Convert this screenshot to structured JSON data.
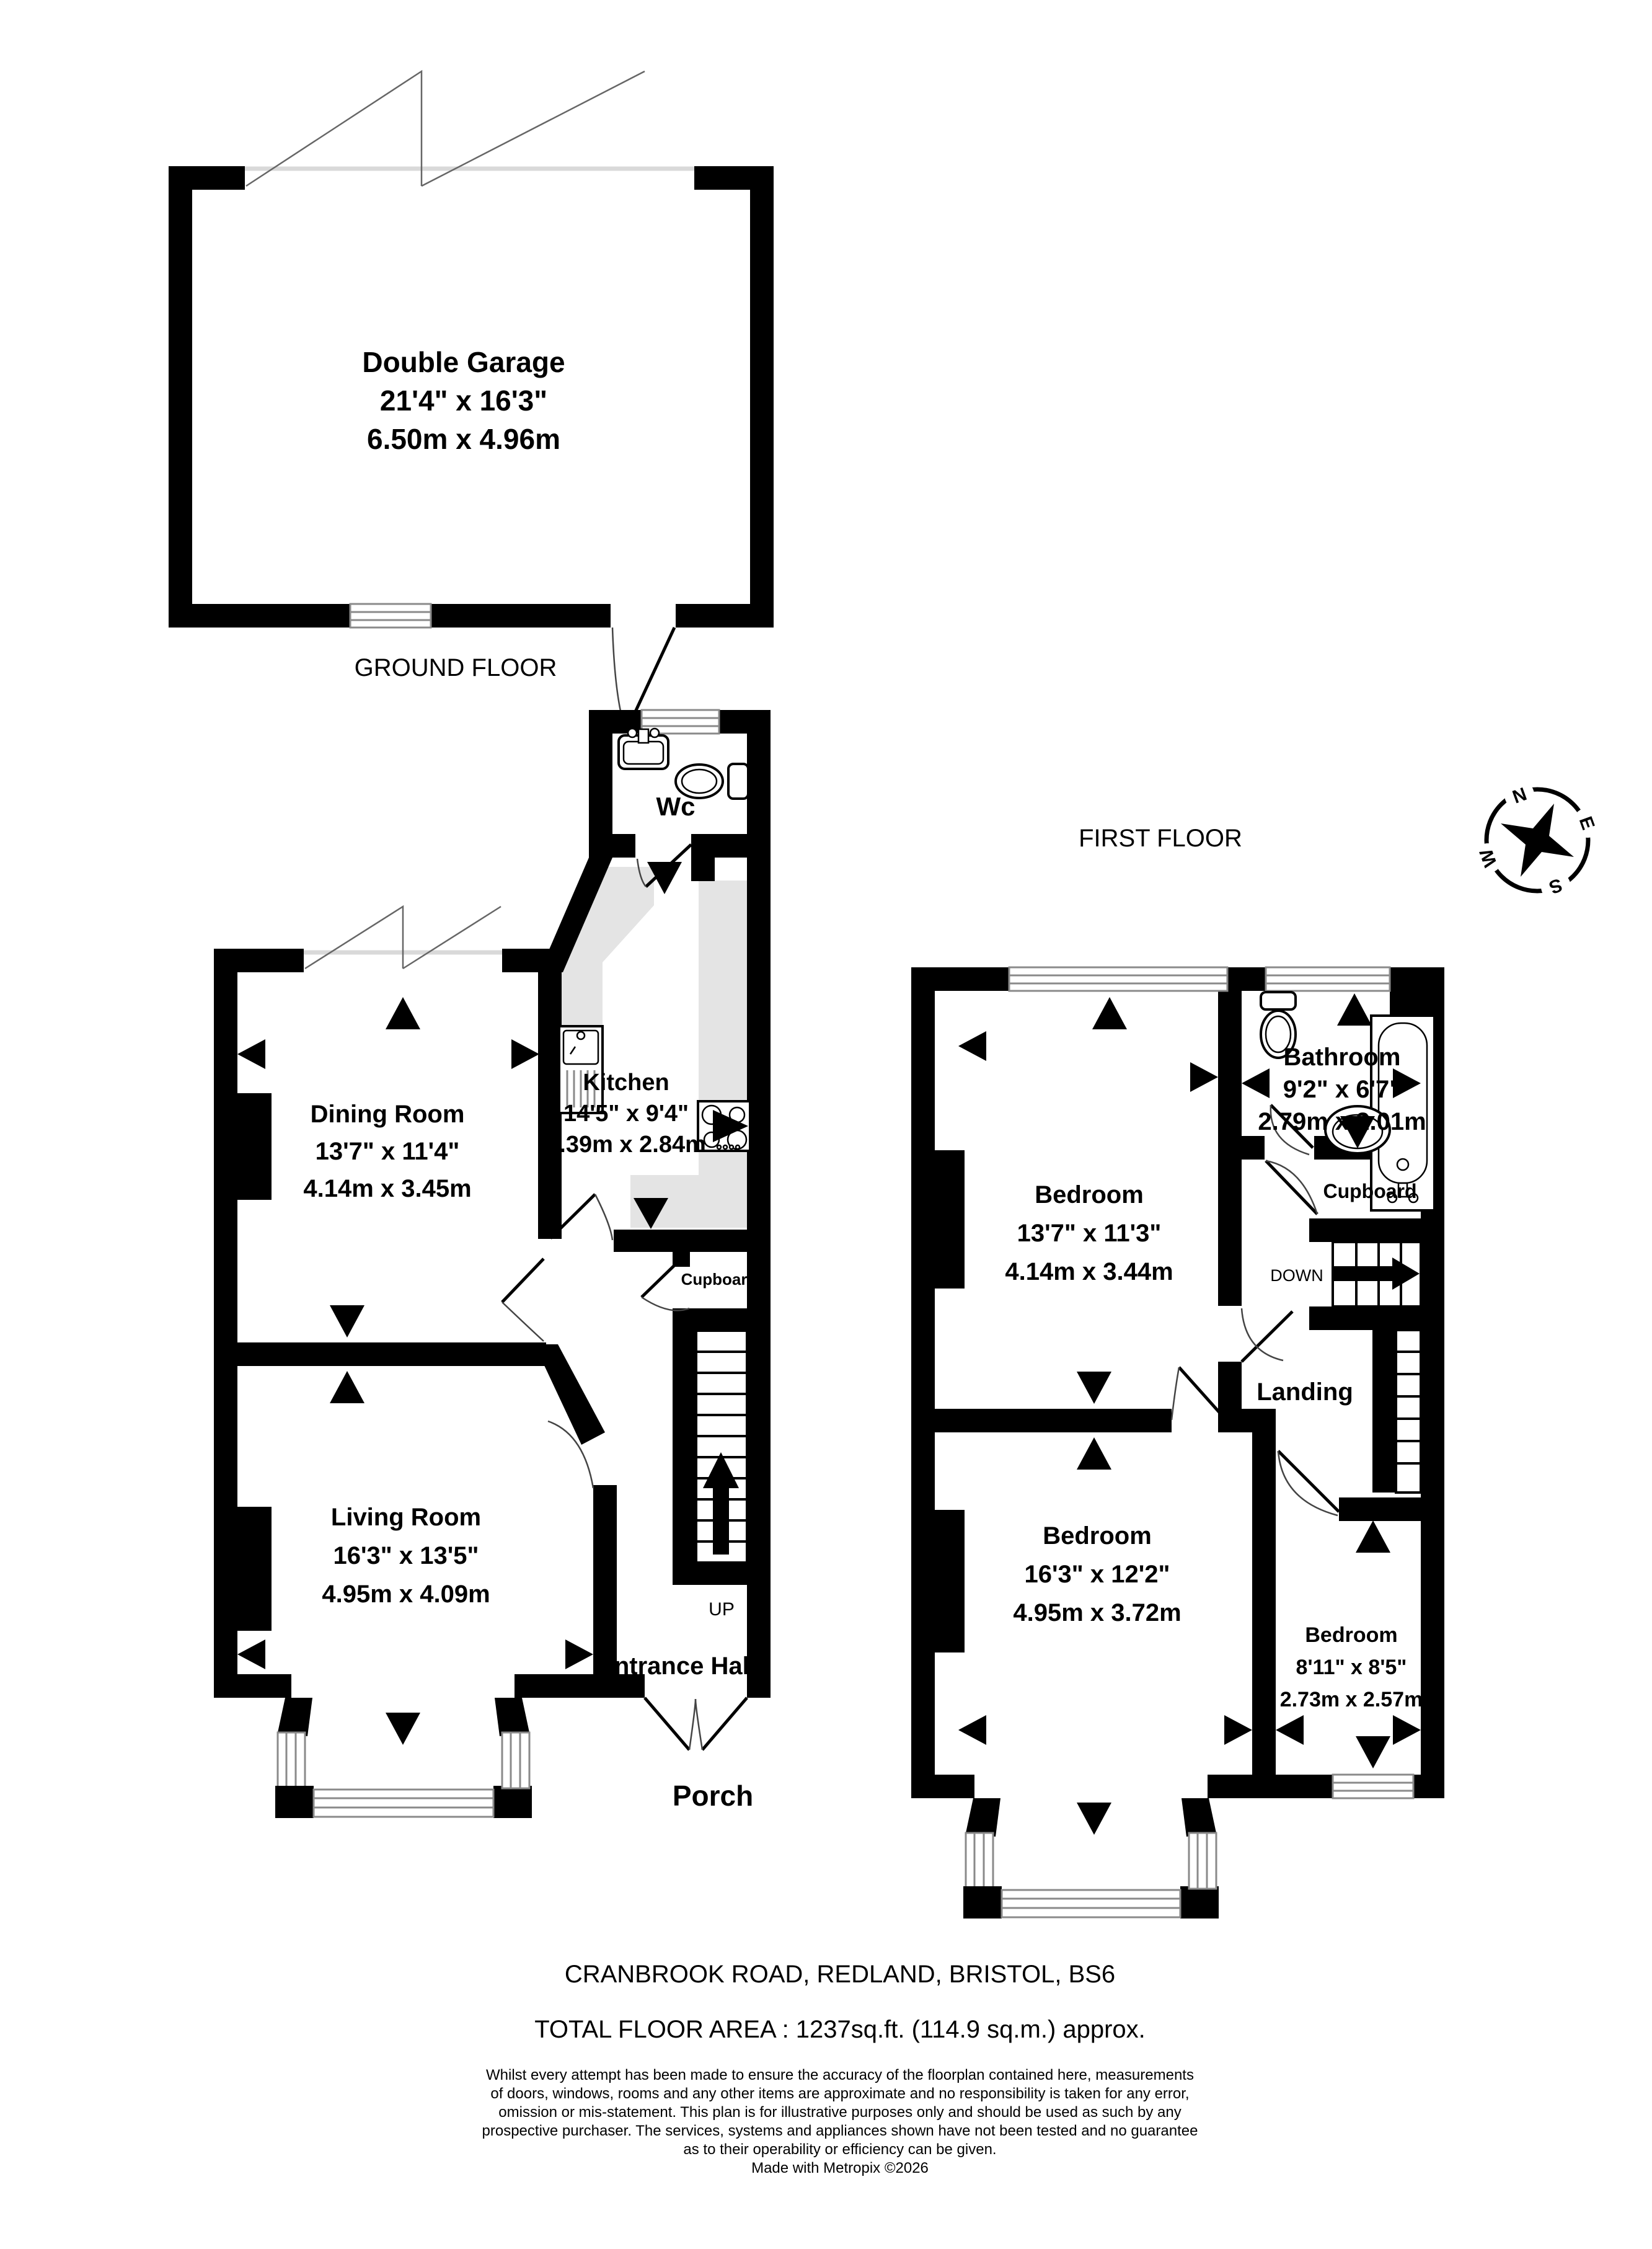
{
  "ground": {
    "floor_label": "GROUND FLOOR",
    "garage": {
      "name": "Double Garage",
      "imperial": "21'4\" x 16'3\"",
      "metric": "6.50m x 4.96m"
    },
    "wc": {
      "name": "Wc"
    },
    "dining": {
      "name": "Dining Room",
      "imperial": "13'7\" x 11'4\"",
      "metric": "4.14m x 3.45m"
    },
    "kitchen": {
      "name": "Kitchen",
      "imperial": "14'5\" x 9'4\"",
      "metric": "4.39m x 2.84m"
    },
    "living": {
      "name": "Living Room",
      "imperial": "16'3\" x 13'5\"",
      "metric": "4.95m x 4.09m"
    },
    "cupboard": {
      "name": "Cupboard"
    },
    "entrance_hall": {
      "name": "Entrance Hall"
    },
    "porch": {
      "name": "Porch"
    },
    "stairs_label": "UP"
  },
  "first": {
    "floor_label": "FIRST FLOOR",
    "bedroom1": {
      "name": "Bedroom",
      "imperial": "13'7\" x 11'3\"",
      "metric": "4.14m x 3.44m"
    },
    "bathroom": {
      "name": "Bathroom",
      "imperial": "9'2\" x 6'7\"",
      "metric": "2.79m x 2.01m"
    },
    "cupboard": {
      "name": "Cupboard"
    },
    "landing": {
      "name": "Landing"
    },
    "bedroom2": {
      "name": "Bedroom",
      "imperial": "16'3\" x 12'2\"",
      "metric": "4.95m x 3.72m"
    },
    "bedroom3": {
      "name": "Bedroom",
      "imperial": "8'11\" x 8'5\"",
      "metric": "2.73m x 2.57m"
    },
    "stairs_label": "DOWN"
  },
  "compass": {
    "north": "N",
    "east": "E",
    "south": "S",
    "west": "W"
  },
  "footer": {
    "address": "CRANBROOK ROAD, REDLAND, BRISTOL, BS6",
    "total_area": "TOTAL FLOOR AREA : 1237sq.ft. (114.9 sq.m.) approx.",
    "disclaimer": [
      "Whilst every attempt has been made to ensure the accuracy of the floorplan contained here, measurements",
      "of doors, windows, rooms and any other items are approximate and no responsibility is taken for any error,",
      "omission or mis-statement. This plan is for illustrative purposes only and should be used as such by any",
      "prospective purchaser. The services, systems and appliances shown have not been tested and no guarantee",
      "as to their operability or efficiency can be given."
    ],
    "credit": "Made with Metropix ©2026"
  }
}
